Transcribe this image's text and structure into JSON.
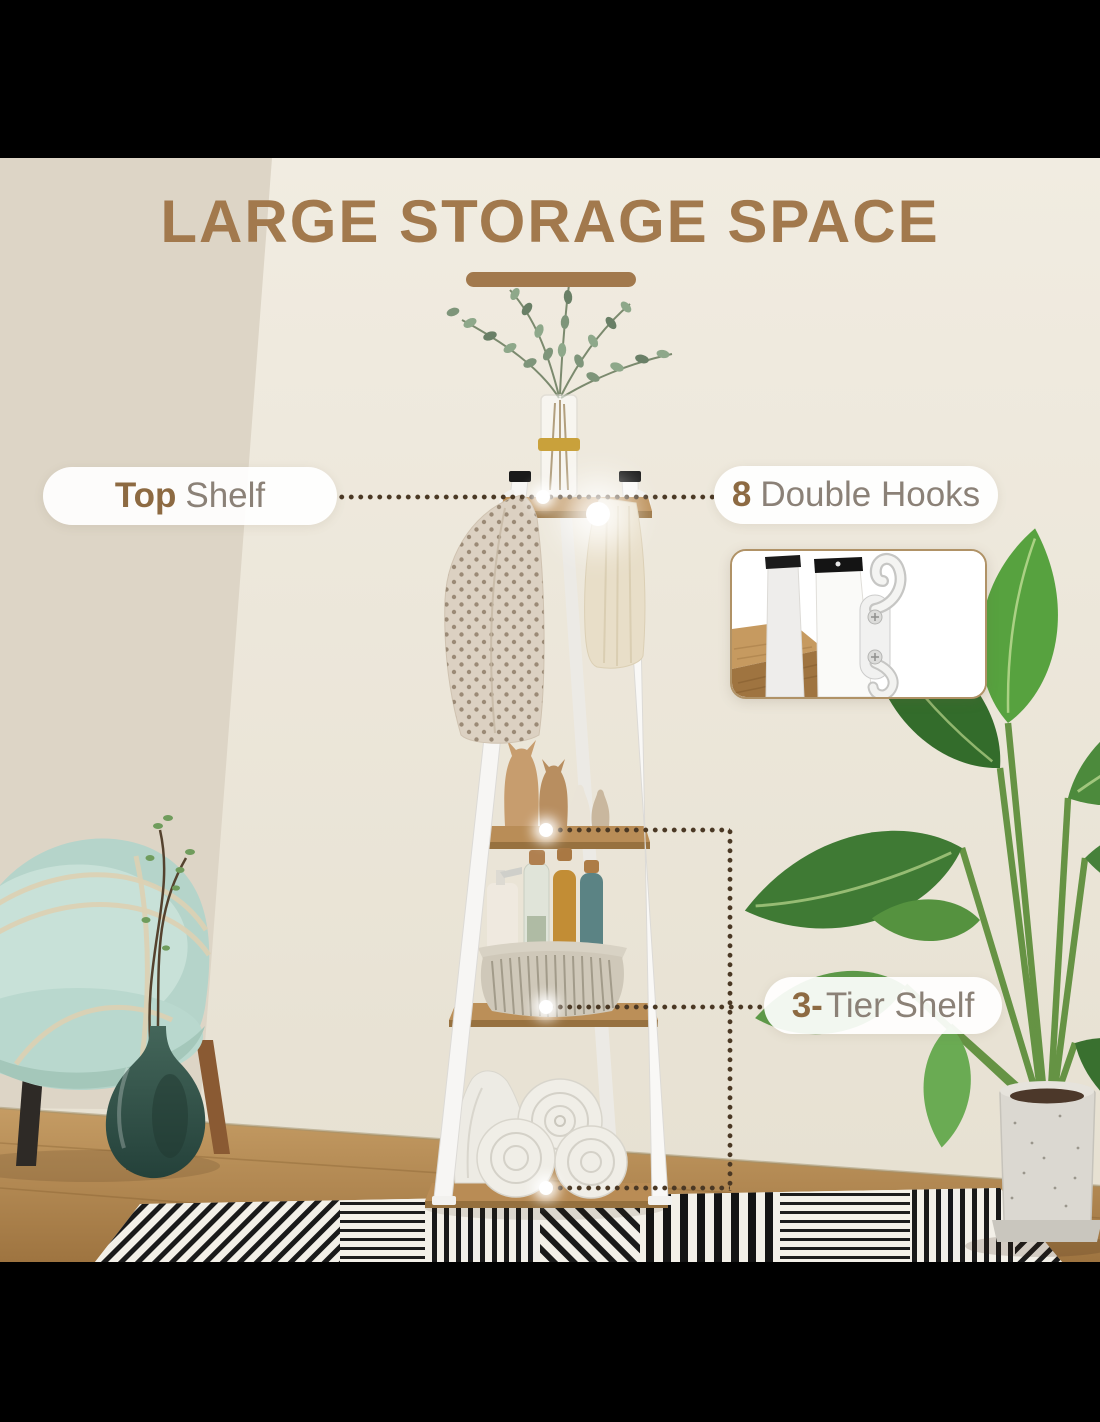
{
  "title": {
    "text": "LARGE STORAGE SPACE"
  },
  "callouts": {
    "top_shelf": {
      "highlight": "Top",
      "label": "Shelf"
    },
    "double_hooks": {
      "highlight": "8",
      "label": "Double Hooks"
    },
    "tier_shelf": {
      "highlight": "3-",
      "label": "Tier Shelf"
    }
  },
  "inset": {
    "description": "double hook close-up"
  },
  "colors": {
    "title_brown": "#A2794D",
    "highlight_brown": "#8D6A42",
    "label_gray": "#8B8177",
    "dotted_line": "#4A3824",
    "pill_background": "#FFFFFF",
    "letterbox": "#000000"
  }
}
